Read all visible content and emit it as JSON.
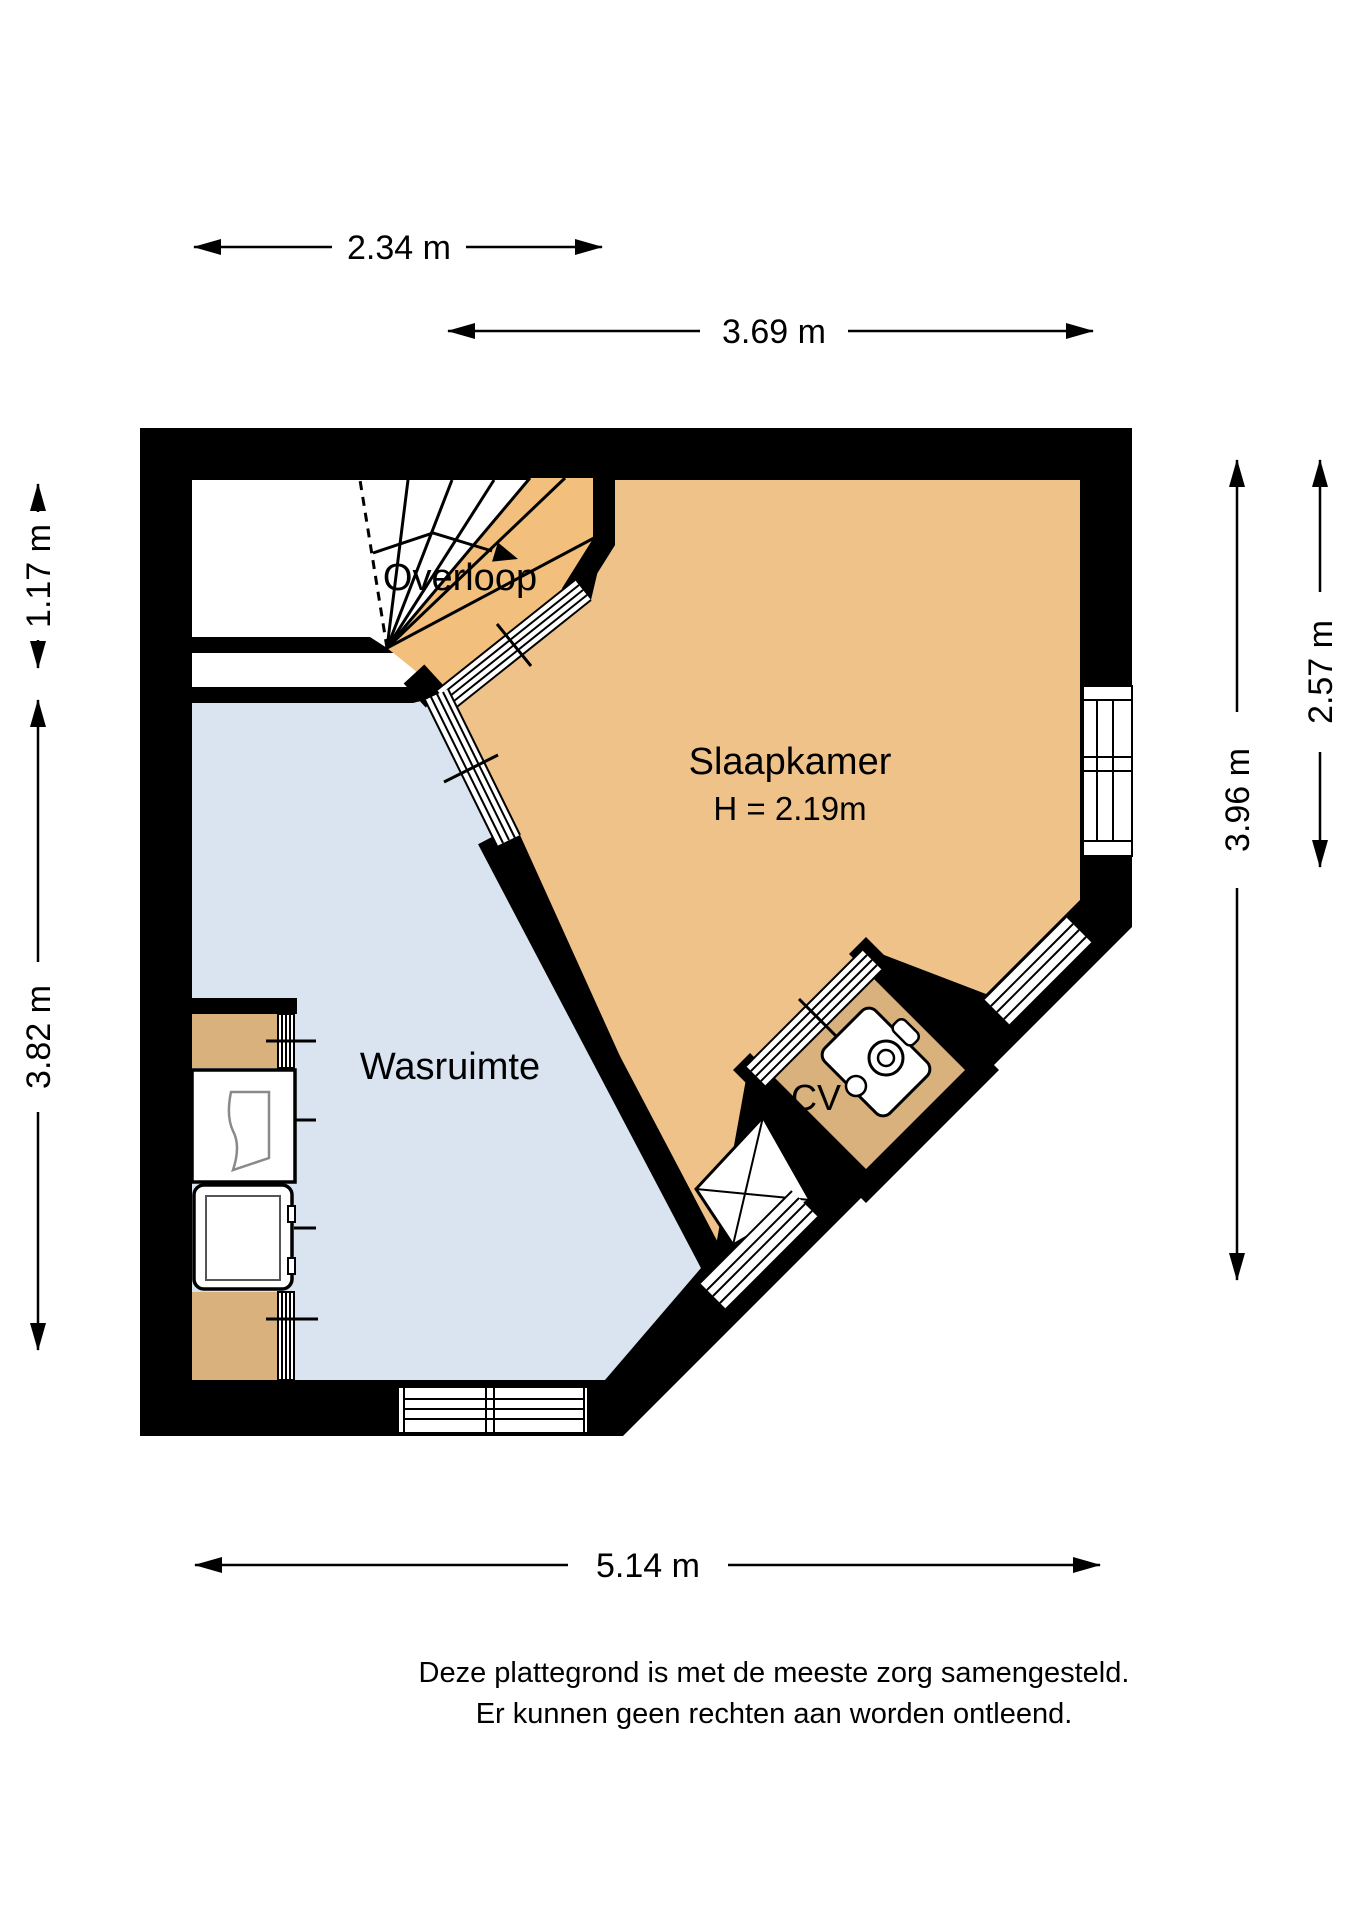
{
  "floorplan": {
    "rooms": {
      "overloop": {
        "label": "Overloop"
      },
      "slaapkamer": {
        "label": "Slaapkamer",
        "ceiling_height": "H = 2.19m"
      },
      "wasruimte": {
        "label": "Wasruimte"
      },
      "cv": {
        "label": "CV"
      }
    },
    "dimensions": {
      "top_stairs_width": "2.34 m",
      "top_bedroom_width": "3.69 m",
      "left_landing_depth": "1.17 m",
      "left_laundry_depth": "3.82 m",
      "right_total_depth": "3.96 m",
      "right_bedroom_depth": "2.57 m",
      "bottom_total_width": "5.14 m"
    },
    "disclaimer": {
      "line1": "Deze plattegrond is met de meeste zorg samengesteld.",
      "line2": "Er kunnen geen rechten aan worden ontleend."
    },
    "colors": {
      "wall": "#000000",
      "bedroom_floor": "#EEC289",
      "landing_floor": "#F2BF7D",
      "laundry_floor": "#D9E4F0",
      "closet_floor": "#D8B17C",
      "window_white": "#FFFFFF"
    }
  }
}
